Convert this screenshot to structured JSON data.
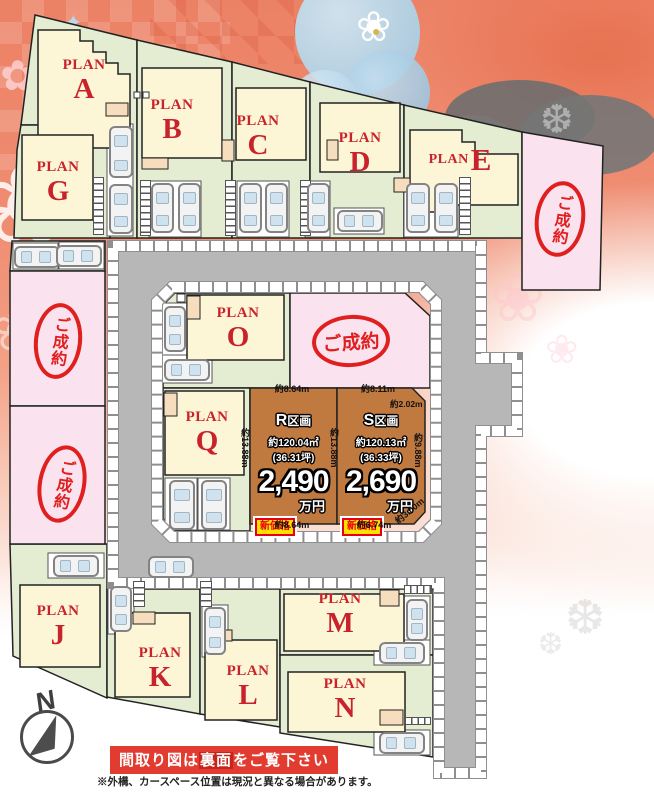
{
  "plans": {
    "A": {
      "prefix": "PLAN",
      "letter": "A"
    },
    "B": {
      "prefix": "PLAN",
      "letter": "B"
    },
    "C": {
      "prefix": "PLAN",
      "letter": "C"
    },
    "D": {
      "prefix": "PLAN",
      "letter": "D"
    },
    "E": {
      "prefix": "PLAN",
      "letter": "E"
    },
    "G": {
      "prefix": "PLAN",
      "letter": "G"
    },
    "O": {
      "prefix": "PLAN",
      "letter": "O"
    },
    "Q": {
      "prefix": "PLAN",
      "letter": "Q"
    },
    "J": {
      "prefix": "PLAN",
      "letter": "J"
    },
    "K": {
      "prefix": "PLAN",
      "letter": "K"
    },
    "L": {
      "prefix": "PLAN",
      "letter": "L"
    },
    "M": {
      "prefix": "PLAN",
      "letter": "M"
    },
    "N": {
      "prefix": "PLAN",
      "letter": "N"
    }
  },
  "sold_stamp": "ご成約",
  "parcels": {
    "R": {
      "name_letter": "R",
      "name_suffix": "区画",
      "area": "約120.04㎡",
      "tsubo": "(36.31坪)",
      "price": "2,490",
      "unit": "万円",
      "badge": "新価格",
      "dims": {
        "top": "約8.64m",
        "left": "約13.88m",
        "bottom": "約8.64m"
      }
    },
    "S": {
      "name_letter": "S",
      "name_suffix": "区画",
      "area": "約120.13㎡",
      "tsubo": "(36.33坪)",
      "price": "2,690",
      "unit": "万円",
      "badge": "新価格",
      "dims": {
        "top": "約8.11m",
        "top_right": "約2.02m",
        "left": "約13.88m",
        "right": "約9.88m",
        "bottom": "約6.74m",
        "bottom_right": "約3.00m"
      }
    }
  },
  "compass": {
    "north": "N"
  },
  "footer": {
    "banner_pre": "間取り図は",
    "banner_highlight": "裏面",
    "banner_post": "をご覧下さい",
    "note": "※外構、カースペース位置は現況と異なる場合があります。"
  },
  "colors": {
    "lot_green": "#e4ecd2",
    "lot_pink": "#fae2ee",
    "lot_brown": "#c0793f",
    "house_cream": "#fdf6d6",
    "stamp_red": "#e01f1f",
    "plan_red": "#c8232c",
    "badge_yellow": "#ffe100",
    "badge_red": "#e60012",
    "banner_red": "#e23b30",
    "road_gray": "#b7b7b7"
  }
}
